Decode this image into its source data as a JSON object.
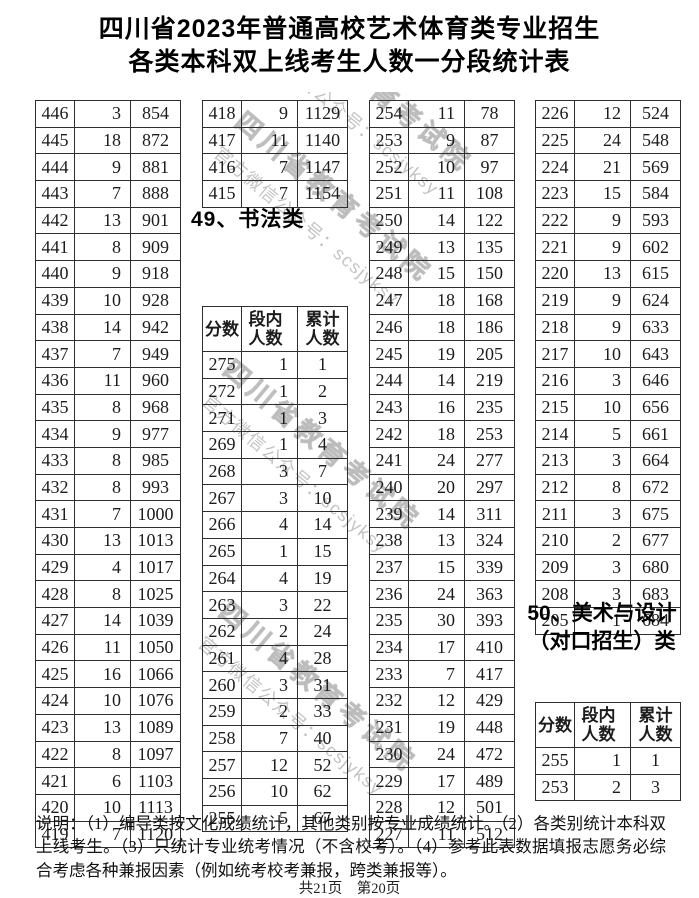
{
  "title": {
    "line1": "四川省2023年普通高校艺术体育类专业招生",
    "line2": "各类本科双上线考生人数一分段统计表"
  },
  "watermark": {
    "line1": "四川省教育考试院",
    "line2": "官方微信公众号：scsjyksy"
  },
  "column_headers": [
    "分数",
    "段内\n人数",
    "累计\n人数"
  ],
  "sections": {
    "calligraphy": {
      "heading": "49、书法类"
    },
    "art_design": {
      "heading_line1": "50、美术与设计",
      "heading_line2": "（对口招生）类"
    }
  },
  "tables": {
    "col1": {
      "rows": [
        [
          446,
          3,
          854
        ],
        [
          445,
          18,
          872
        ],
        [
          444,
          9,
          881
        ],
        [
          443,
          7,
          888
        ],
        [
          442,
          13,
          901
        ],
        [
          441,
          8,
          909
        ],
        [
          440,
          9,
          918
        ],
        [
          439,
          10,
          928
        ],
        [
          438,
          14,
          942
        ],
        [
          437,
          7,
          949
        ],
        [
          436,
          11,
          960
        ],
        [
          435,
          8,
          968
        ],
        [
          434,
          9,
          977
        ],
        [
          433,
          8,
          985
        ],
        [
          432,
          8,
          993
        ],
        [
          431,
          7,
          1000
        ],
        [
          430,
          13,
          1013
        ],
        [
          429,
          4,
          1017
        ],
        [
          428,
          8,
          1025
        ],
        [
          427,
          14,
          1039
        ],
        [
          426,
          11,
          1050
        ],
        [
          425,
          16,
          1066
        ],
        [
          424,
          10,
          1076
        ],
        [
          423,
          13,
          1089
        ],
        [
          422,
          8,
          1097
        ],
        [
          421,
          6,
          1103
        ],
        [
          420,
          10,
          1113
        ],
        [
          419,
          7,
          1120
        ]
      ]
    },
    "col2_top": {
      "rows": [
        [
          418,
          9,
          1129
        ],
        [
          417,
          11,
          1140
        ],
        [
          416,
          7,
          1147
        ],
        [
          415,
          7,
          1154
        ]
      ]
    },
    "calligraphy": {
      "with_header": true,
      "rows": [
        [
          275,
          1,
          1
        ],
        [
          272,
          1,
          2
        ],
        [
          271,
          1,
          3
        ],
        [
          269,
          1,
          4
        ],
        [
          268,
          3,
          7
        ],
        [
          267,
          3,
          10
        ],
        [
          266,
          4,
          14
        ],
        [
          265,
          1,
          15
        ],
        [
          264,
          4,
          19
        ],
        [
          263,
          3,
          22
        ],
        [
          262,
          2,
          24
        ],
        [
          261,
          4,
          28
        ],
        [
          260,
          3,
          31
        ],
        [
          259,
          2,
          33
        ],
        [
          258,
          7,
          40
        ],
        [
          257,
          12,
          52
        ],
        [
          256,
          10,
          62
        ],
        [
          255,
          5,
          67
        ]
      ]
    },
    "col3": {
      "rows": [
        [
          254,
          11,
          78
        ],
        [
          253,
          9,
          87
        ],
        [
          252,
          10,
          97
        ],
        [
          251,
          11,
          108
        ],
        [
          250,
          14,
          122
        ],
        [
          249,
          13,
          135
        ],
        [
          248,
          15,
          150
        ],
        [
          247,
          18,
          168
        ],
        [
          246,
          18,
          186
        ],
        [
          245,
          19,
          205
        ],
        [
          244,
          14,
          219
        ],
        [
          243,
          16,
          235
        ],
        [
          242,
          18,
          253
        ],
        [
          241,
          24,
          277
        ],
        [
          240,
          20,
          297
        ],
        [
          239,
          14,
          311
        ],
        [
          238,
          13,
          324
        ],
        [
          237,
          15,
          339
        ],
        [
          236,
          24,
          363
        ],
        [
          235,
          30,
          393
        ],
        [
          234,
          17,
          410
        ],
        [
          233,
          7,
          417
        ],
        [
          232,
          12,
          429
        ],
        [
          231,
          19,
          448
        ],
        [
          230,
          24,
          472
        ],
        [
          229,
          17,
          489
        ],
        [
          228,
          12,
          501
        ],
        [
          227,
          11,
          512
        ]
      ]
    },
    "col4_top": {
      "rows": [
        [
          226,
          12,
          524
        ],
        [
          225,
          24,
          548
        ],
        [
          224,
          21,
          569
        ],
        [
          223,
          15,
          584
        ],
        [
          222,
          9,
          593
        ],
        [
          221,
          9,
          602
        ],
        [
          220,
          13,
          615
        ],
        [
          219,
          9,
          624
        ],
        [
          218,
          9,
          633
        ],
        [
          217,
          10,
          643
        ],
        [
          216,
          3,
          646
        ],
        [
          215,
          10,
          656
        ],
        [
          214,
          5,
          661
        ],
        [
          213,
          3,
          664
        ],
        [
          212,
          8,
          672
        ],
        [
          211,
          3,
          675
        ],
        [
          210,
          2,
          677
        ],
        [
          209,
          3,
          680
        ],
        [
          208,
          3,
          683
        ],
        [
          205,
          1,
          684
        ]
      ]
    },
    "art_design": {
      "with_header": true,
      "rows": [
        [
          255,
          1,
          1
        ],
        [
          253,
          2,
          3
        ]
      ]
    }
  },
  "footer": {
    "notes": "说明：（1）编导类按文化成绩统计，其他类别按专业成绩统计。（2）各类别统计本科双上线考生。（3）只统计专业统考情况（不含校考）。（4）参考此表数据填报志愿务必综合考虑各种兼报因素（例如统考校考兼报，跨类兼报等）。",
    "page_info": "共21页　第20页"
  }
}
